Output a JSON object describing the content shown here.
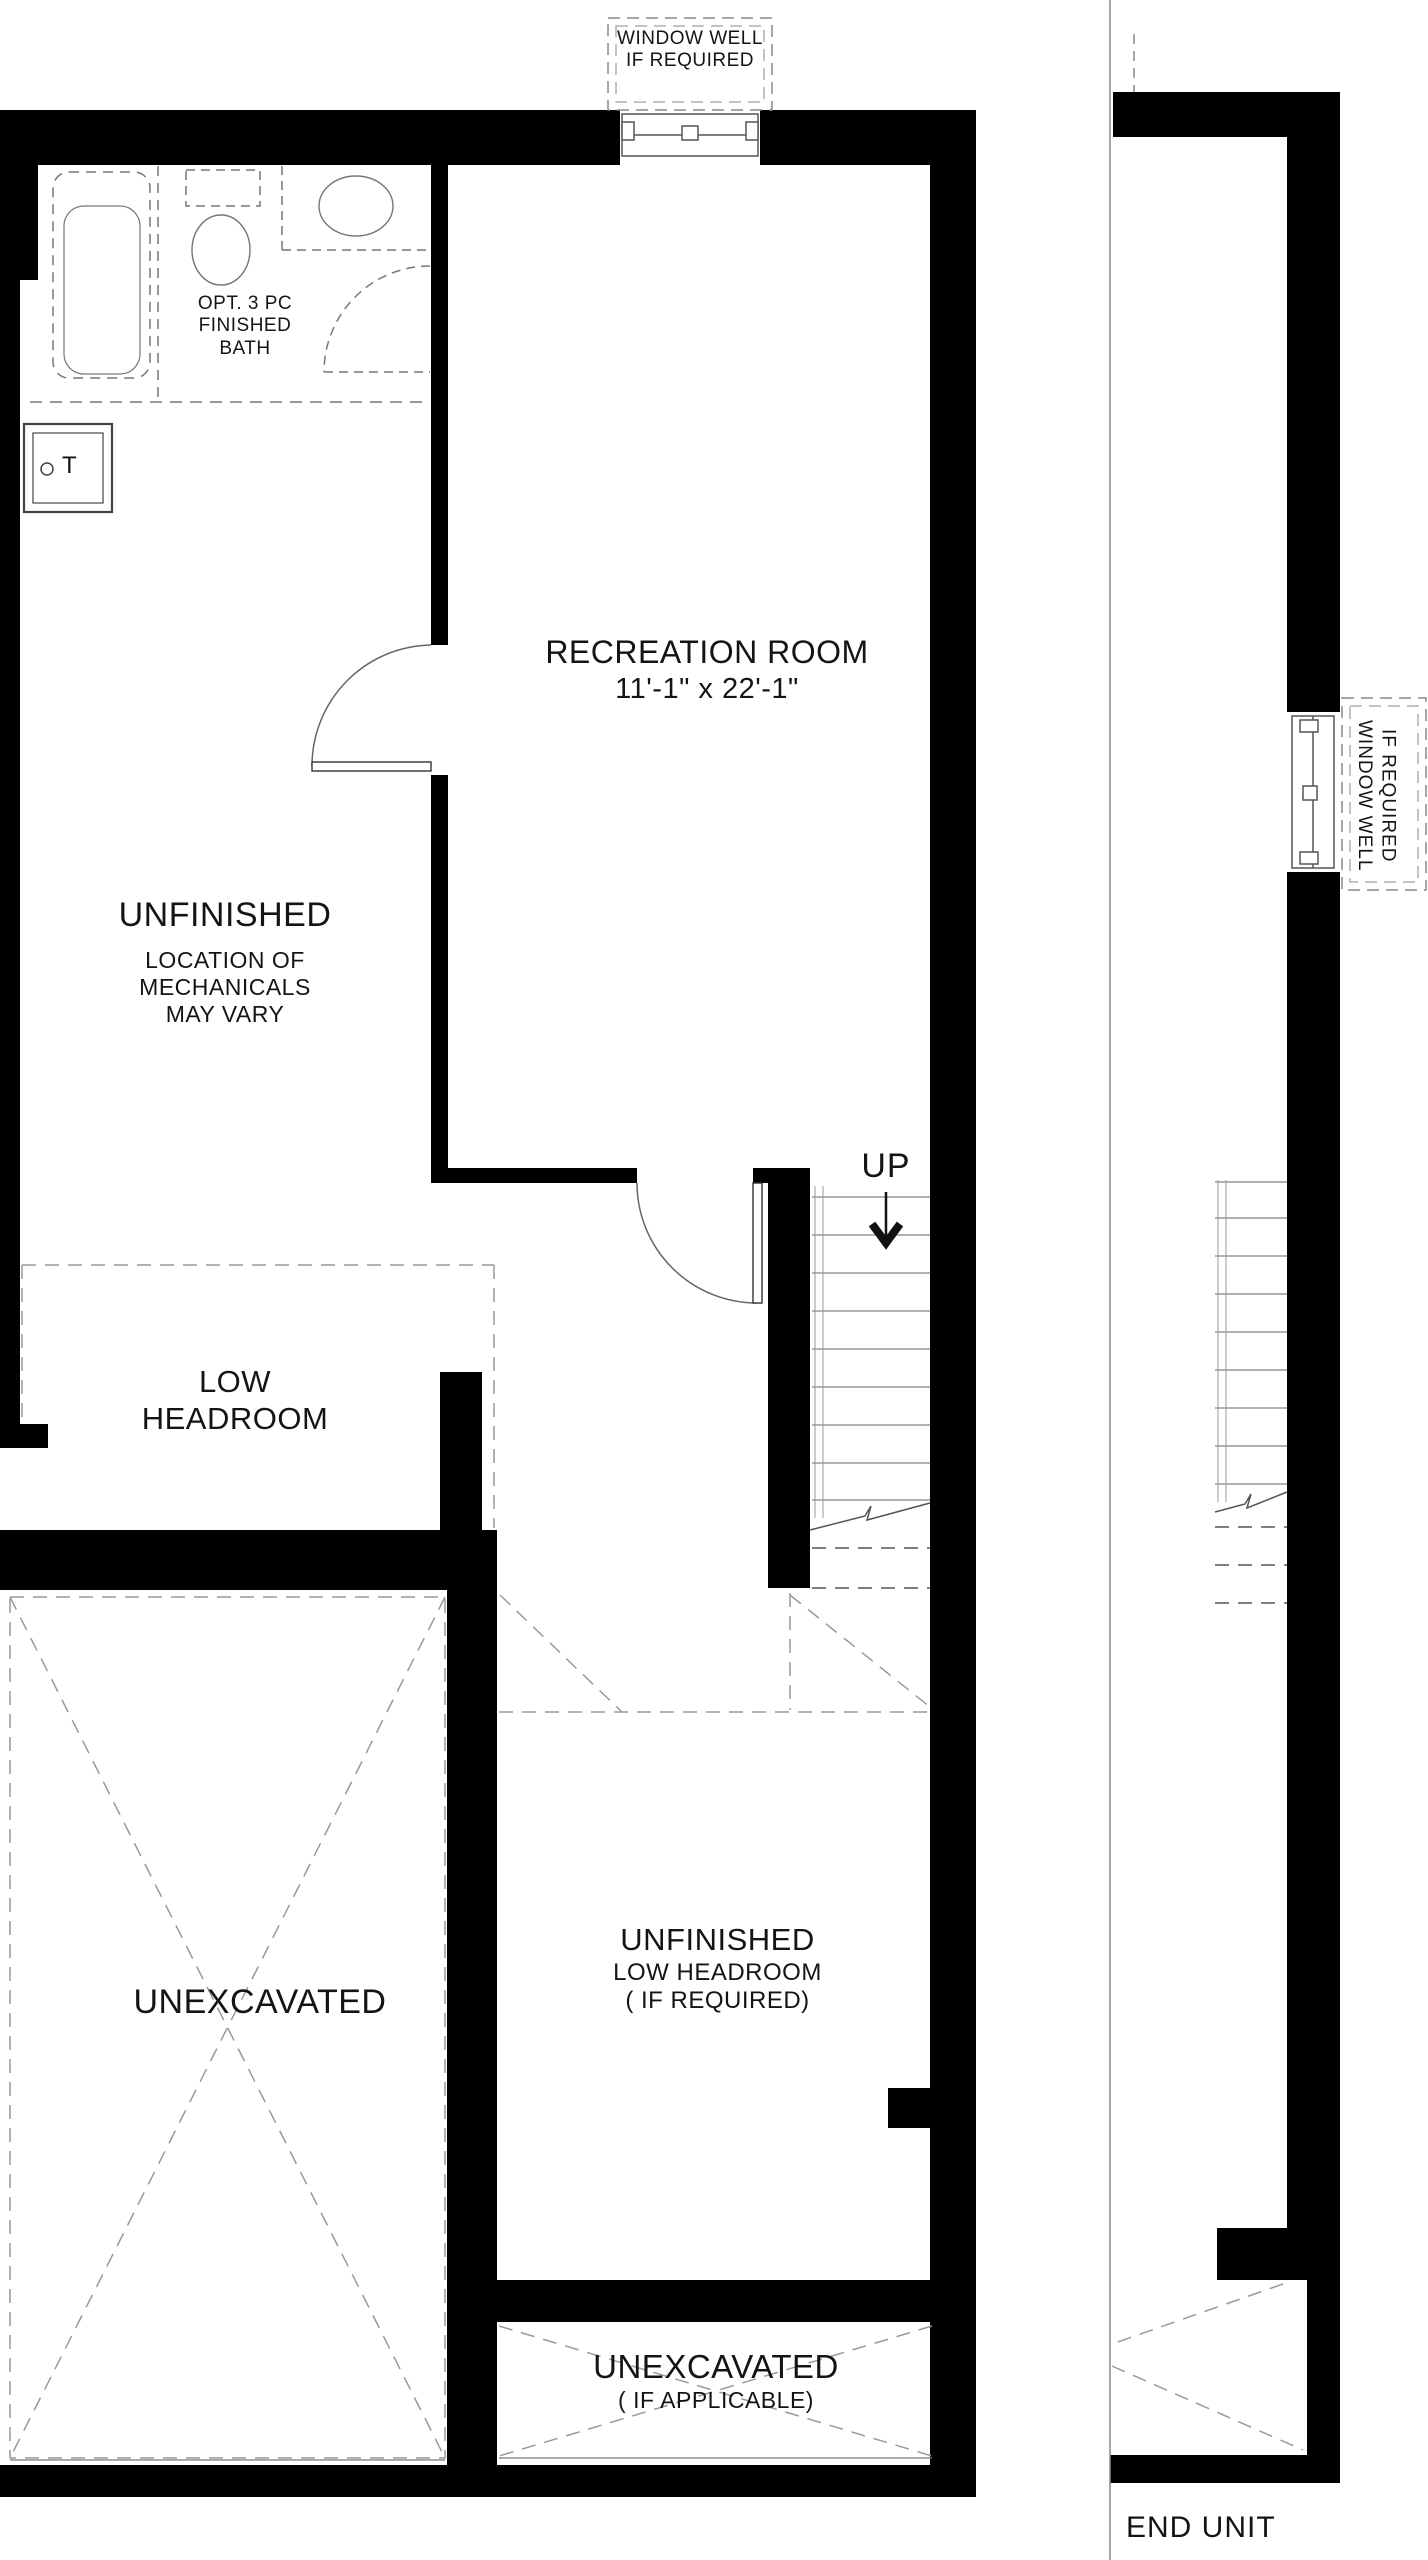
{
  "colors": {
    "wall": "#000000",
    "thin_line": "#666666",
    "dashed_line": "#8a8a8a",
    "fixture_line": "#777777",
    "background": "#ffffff",
    "text": "#141414"
  },
  "labels": {
    "top_window_well": {
      "line1": "WINDOW WELL",
      "line2": "IF REQUIRED"
    },
    "bath": {
      "line1": "OPT. 3 PC",
      "line2": "FINISHED",
      "line3": "BATH"
    },
    "tank": {
      "letter": "T"
    },
    "recreation_room": {
      "name": "RECREATION ROOM",
      "dimensions": "11'-1\" x 22'-1\""
    },
    "unfinished_mechanical": {
      "title": "UNFINISHED",
      "line1": "LOCATION OF",
      "line2": "MECHANICALS",
      "line3": "MAY VARY"
    },
    "stairs": {
      "direction": "UP"
    },
    "low_headroom": {
      "line1": "LOW",
      "line2": "HEADROOM"
    },
    "unexcavated_left": {
      "title": "UNEXCAVATED"
    },
    "unfinished_low_headroom": {
      "title": "UNFINISHED",
      "line1": "LOW HEADROOM",
      "line2": "( IF REQUIRED)"
    },
    "unexcavated_bottom": {
      "title": "UNEXCAVATED",
      "subtitle": "( IF APPLICABLE)"
    },
    "right_window_well": {
      "line1": "WINDOW WELL",
      "line2": "IF REQUIRED"
    },
    "end_unit": {
      "title": "END UNIT"
    }
  }
}
